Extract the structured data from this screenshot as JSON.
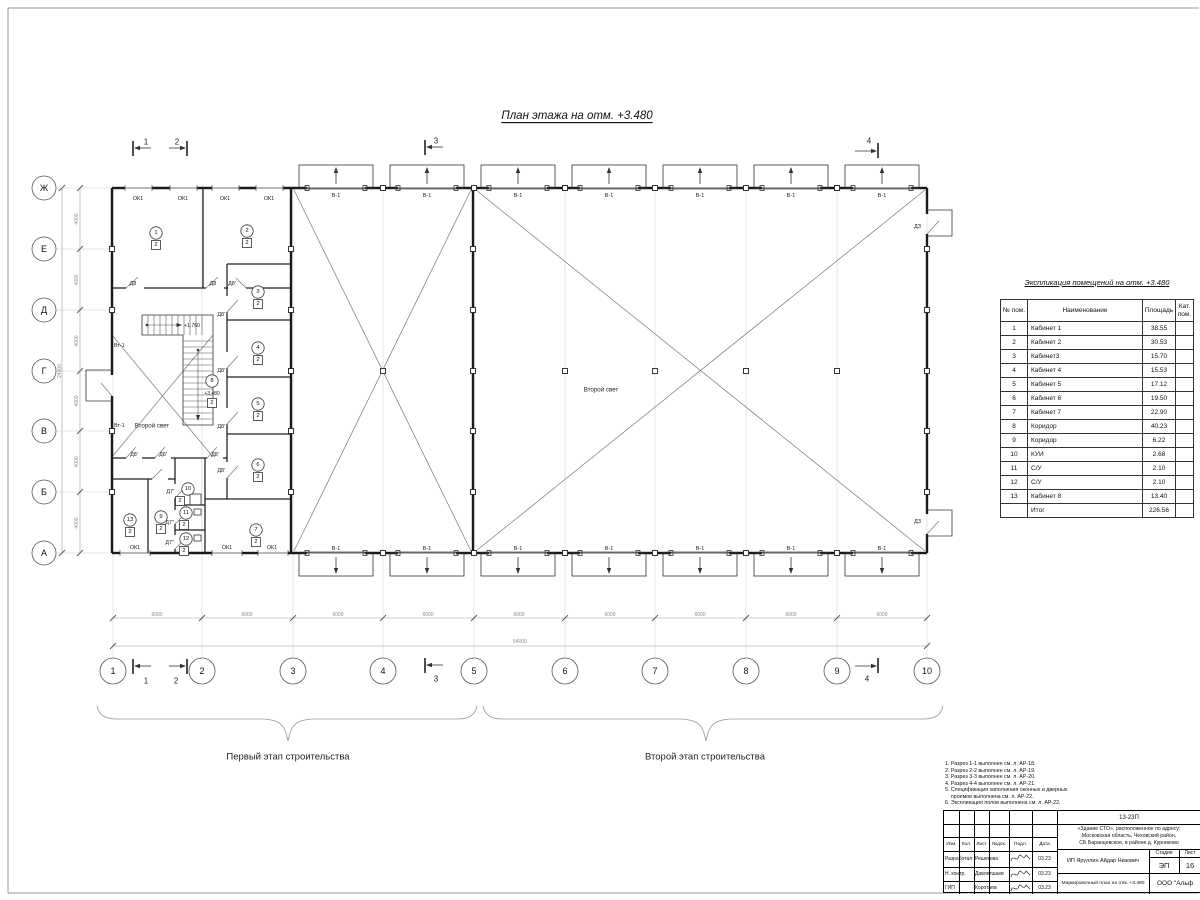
{
  "sheet_title": "План этажа на отм. +3.480",
  "plan": {
    "axes_bottom": [
      "1",
      "2",
      "3",
      "4",
      "5",
      "6",
      "7",
      "8",
      "9",
      "10"
    ],
    "axes_left": [
      "Ж",
      "Е",
      "Д",
      "Г",
      "В",
      "Б",
      "А"
    ],
    "stage1": "Первый этап строительства",
    "stage2": "Второй этап строительства",
    "rooms": [
      {
        "n": "1",
        "c": "2",
        "x": 156,
        "y": 233
      },
      {
        "n": "2",
        "c": "2",
        "x": 247,
        "y": 231
      },
      {
        "n": "3",
        "c": "2",
        "x": 258,
        "y": 292
      },
      {
        "n": "4",
        "c": "2",
        "x": 258,
        "y": 348
      },
      {
        "n": "5",
        "c": "2",
        "x": 258,
        "y": 404
      },
      {
        "n": "6",
        "c": "2",
        "x": 258,
        "y": 465
      },
      {
        "n": "7",
        "c": "2",
        "x": 256,
        "y": 530
      },
      {
        "n": "8",
        "c": "2",
        "x": 212,
        "y": 381,
        "e": "+3.480"
      },
      {
        "n": "9",
        "c": "2",
        "x": 161,
        "y": 517
      },
      {
        "n": "10",
        "c": "2",
        "x": 188,
        "y": 489,
        "dx": -8
      },
      {
        "n": "11",
        "c": "2",
        "x": 186,
        "y": 513,
        "dx": -2
      },
      {
        "n": "12",
        "c": "2",
        "x": 186,
        "y": 539,
        "dx": -2
      },
      {
        "n": "13",
        "c": "2",
        "x": 130,
        "y": 520
      }
    ],
    "labels": [
      {
        "t": "ОК1",
        "x": 138,
        "y": 199
      },
      {
        "t": "ОК1",
        "x": 183,
        "y": 199
      },
      {
        "t": "ОК1",
        "x": 225,
        "y": 199
      },
      {
        "t": "ОК1",
        "x": 269,
        "y": 199
      },
      {
        "t": "ОК1",
        "x": 135,
        "y": 548
      },
      {
        "t": "ОК1",
        "x": 227,
        "y": 548
      },
      {
        "t": "ОК1",
        "x": 272,
        "y": 548
      },
      {
        "t": "В-1",
        "x": 336,
        "y": 196
      },
      {
        "t": "В-1",
        "x": 427,
        "y": 196
      },
      {
        "t": "В-1",
        "x": 518,
        "y": 196
      },
      {
        "t": "В-1",
        "x": 609,
        "y": 196
      },
      {
        "t": "В-1",
        "x": 700,
        "y": 196
      },
      {
        "t": "В-1",
        "x": 791,
        "y": 196
      },
      {
        "t": "В-1",
        "x": 882,
        "y": 196
      },
      {
        "t": "В-1",
        "x": 336,
        "y": 549
      },
      {
        "t": "В-1",
        "x": 427,
        "y": 549
      },
      {
        "t": "В-1",
        "x": 518,
        "y": 549
      },
      {
        "t": "В-1",
        "x": 609,
        "y": 549
      },
      {
        "t": "В-1",
        "x": 700,
        "y": 549
      },
      {
        "t": "В-1",
        "x": 791,
        "y": 549
      },
      {
        "t": "В-1",
        "x": 882,
        "y": 549
      },
      {
        "t": "Д8",
        "x": 133,
        "y": 284
      },
      {
        "t": "Д8",
        "x": 213,
        "y": 284
      },
      {
        "t": "Д8'",
        "x": 232,
        "y": 284
      },
      {
        "t": "Д8'",
        "x": 225,
        "y": 315,
        "a": "end"
      },
      {
        "t": "Д8'",
        "x": 225,
        "y": 371,
        "a": "end"
      },
      {
        "t": "Д8'",
        "x": 225,
        "y": 427,
        "a": "end"
      },
      {
        "t": "Д8'",
        "x": 225,
        "y": 471,
        "a": "end"
      },
      {
        "t": "Д8'",
        "x": 134,
        "y": 455
      },
      {
        "t": "Д8'",
        "x": 163,
        "y": 455
      },
      {
        "t": "Д8'",
        "x": 215,
        "y": 455
      },
      {
        "t": "Д7'",
        "x": 174,
        "y": 492,
        "a": "end"
      },
      {
        "t": "Д7''",
        "x": 174,
        "y": 523,
        "a": "end"
      },
      {
        "t": "Д7''",
        "x": 174,
        "y": 543,
        "a": "end"
      },
      {
        "t": "ДЗ",
        "x": 921,
        "y": 227,
        "a": "end"
      },
      {
        "t": "ДЗ",
        "x": 921,
        "y": 522,
        "a": "end"
      },
      {
        "t": "Вт-1",
        "x": 114,
        "y": 346,
        "a": "start"
      },
      {
        "t": "Вт-1",
        "x": 114,
        "y": 426,
        "a": "start"
      },
      {
        "t": "Второй свет",
        "x": 152,
        "y": 426,
        "fs": 6.2
      },
      {
        "t": "Второй свет",
        "x": 601,
        "y": 390,
        "fs": 6.2
      },
      {
        "t": "+1.760",
        "x": 184,
        "y": 326,
        "a": "start",
        "fs": 5.2
      },
      {
        "t": "1",
        "x": 146,
        "y": 142,
        "fs": 8
      },
      {
        "t": "2",
        "x": 177,
        "y": 142,
        "fs": 8
      },
      {
        "t": "3",
        "x": 436,
        "y": 141,
        "fs": 8
      },
      {
        "t": "4",
        "x": 869,
        "y": 141,
        "fs": 8
      },
      {
        "t": "1",
        "x": 146,
        "y": 681,
        "fs": 8
      },
      {
        "t": "2",
        "x": 176,
        "y": 681,
        "fs": 8
      },
      {
        "t": "3",
        "x": 436,
        "y": 679,
        "fs": 8
      },
      {
        "t": "4",
        "x": 867,
        "y": 679,
        "fs": 8
      },
      {
        "t": "6000",
        "x": 157,
        "y": 615,
        "c": 1,
        "fs": 5
      },
      {
        "t": "6000",
        "x": 247,
        "y": 615,
        "c": 1,
        "fs": 5
      },
      {
        "t": "6000",
        "x": 338,
        "y": 615,
        "c": 1,
        "fs": 5
      },
      {
        "t": "6000",
        "x": 428,
        "y": 615,
        "c": 1,
        "fs": 5
      },
      {
        "t": "6000",
        "x": 519,
        "y": 615,
        "c": 1,
        "fs": 5
      },
      {
        "t": "6000",
        "x": 610,
        "y": 615,
        "c": 1,
        "fs": 5
      },
      {
        "t": "6000",
        "x": 700,
        "y": 615,
        "c": 1,
        "fs": 5
      },
      {
        "t": "6000",
        "x": 791,
        "y": 615,
        "c": 1,
        "fs": 5
      },
      {
        "t": "6000",
        "x": 882,
        "y": 615,
        "c": 1,
        "fs": 5
      },
      {
        "t": "54000",
        "x": 520,
        "y": 642,
        "c": 1,
        "fs": 5
      },
      {
        "t": "4000",
        "x": 77,
        "y": 219,
        "c": 1,
        "fs": 5,
        "r": 1
      },
      {
        "t": "4000",
        "x": 77,
        "y": 280,
        "c": 1,
        "fs": 5,
        "r": 1
      },
      {
        "t": "4000",
        "x": 77,
        "y": 341,
        "c": 1,
        "fs": 5,
        "r": 1
      },
      {
        "t": "4000",
        "x": 77,
        "y": 401,
        "c": 1,
        "fs": 5,
        "r": 1
      },
      {
        "t": "4000",
        "x": 77,
        "y": 462,
        "c": 1,
        "fs": 5,
        "r": 1
      },
      {
        "t": "4000",
        "x": 77,
        "y": 523,
        "c": 1,
        "fs": 5,
        "r": 1
      },
      {
        "t": "24000",
        "x": 60,
        "y": 371,
        "c": 1,
        "fs": 5,
        "r": 1
      }
    ]
  },
  "explication": {
    "title": "Экспликация помещений на отм. +3.480",
    "col_num": "№ пом.",
    "col_name": "Наименование",
    "col_area": "Площадь",
    "col_cat": "Кат. пом.",
    "rows": [
      [
        "1",
        "Кабинет 1",
        "38.55"
      ],
      [
        "2",
        "Кабинет 2",
        "30.53"
      ],
      [
        "3",
        "Кабинет3",
        "15.70"
      ],
      [
        "4",
        "Кабинет 4",
        "15.53"
      ],
      [
        "5",
        "Кабинет 5",
        "17.12"
      ],
      [
        "6",
        "Кабинет 6",
        "19.50"
      ],
      [
        "7",
        "Кабинет 7",
        "22.90"
      ],
      [
        "8",
        "Коридор",
        "40.23"
      ],
      [
        "9",
        "Коридор",
        "6.22"
      ],
      [
        "10",
        "КУИ",
        "2.68"
      ],
      [
        "11",
        "С/У",
        "2.10"
      ],
      [
        "12",
        "С/У",
        "2.10"
      ],
      [
        "13",
        "Кабинет 8",
        "13.40"
      ]
    ],
    "total_label": "Итог",
    "total_value": "226.56"
  },
  "notes": [
    "1. Разрез 1-1 выполнен см. л. АР-18.",
    "2. Разрез 2-2 выполнен см. л. АР-19.",
    "3. Разрез 3-3 выполнен см. л. АР-20.",
    "4. Разрез 4-4 выполнен см. л. АР-21.",
    "5. Спецификация заполнения оконных и дверных",
    "    проемов выполнена см. л. АР-22.",
    "6. Экспликация полов выполнена см. л. АР-22."
  ],
  "titleblock": {
    "code": "13-23П",
    "address_lines": [
      "«Здание СТО», расположенное по адресу:",
      "Московская область, Чеховский район,",
      "СБ Баранцевское, в районе д. Курниково"
    ],
    "cols": [
      "Изм.",
      "Кол.",
      "Лист",
      "№док.",
      "Подл.",
      "Дата"
    ],
    "people": [
      {
        "role": "Разработал",
        "name": "Решетова",
        "date": "03.23"
      },
      {
        "role": "Н. контр.",
        "name": "Давлетшаев",
        "date": "03.23"
      },
      {
        "role": "ГИП",
        "name": "Коротаев",
        "date": "03.23"
      }
    ],
    "client": "ИП Яруллин Айдар Низович",
    "stage_label": "Стадия",
    "stage": "ЭП",
    "sheet_label": "Лист",
    "sheet": "16",
    "doc_name": "Маркировочный план на отм. +3.480",
    "company": "ООО \"Альф"
  }
}
